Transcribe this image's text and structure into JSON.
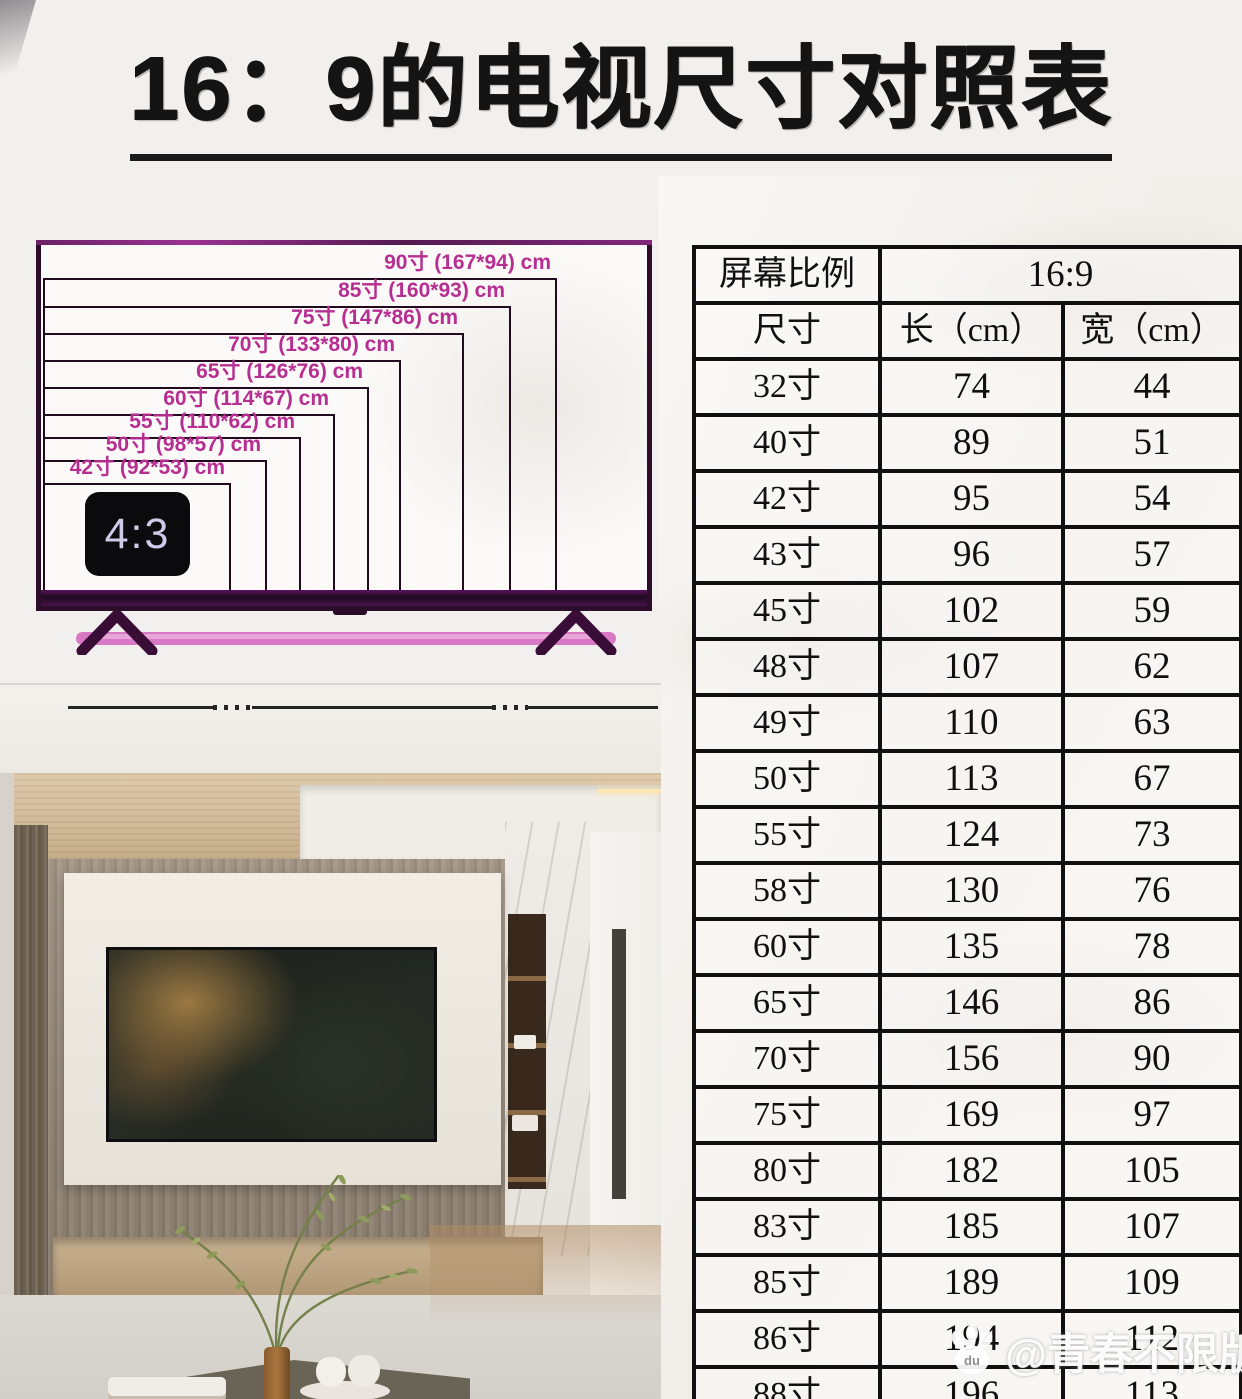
{
  "title": {
    "text": "16：9的电视尺寸对照表"
  },
  "diagram": {
    "aspect_badge": "4:3",
    "sizes": [
      {
        "label": "90寸 (167*94) cm",
        "size": "90寸",
        "length_cm": 167,
        "width_cm": 94
      },
      {
        "label": "85寸 (160*93) cm",
        "size": "85寸",
        "length_cm": 160,
        "width_cm": 93
      },
      {
        "label": "75寸 (147*86) cm",
        "size": "75寸",
        "length_cm": 147,
        "width_cm": 86
      },
      {
        "label": "70寸 (133*80) cm",
        "size": "70寸",
        "length_cm": 133,
        "width_cm": 80
      },
      {
        "label": "65寸 (126*76) cm",
        "size": "65寸",
        "length_cm": 126,
        "width_cm": 76
      },
      {
        "label": "60寸 (114*67) cm",
        "size": "60寸",
        "length_cm": 114,
        "width_cm": 67
      },
      {
        "label": "55寸 (110*62) cm",
        "size": "55寸",
        "length_cm": 110,
        "width_cm": 62
      },
      {
        "label": "50寸 (98*57) cm",
        "size": "50寸",
        "length_cm": 98,
        "width_cm": 57
      },
      {
        "label": "42寸 (92*53) cm",
        "size": "42寸",
        "length_cm": 92,
        "width_cm": 53
      }
    ]
  },
  "table": {
    "ratio_label": "屏幕比例",
    "ratio_value": "16:9",
    "columns": [
      "尺寸",
      "长（cm）",
      "宽（cm）"
    ],
    "rows": [
      [
        "32寸",
        "74",
        "44"
      ],
      [
        "40寸",
        "89",
        "51"
      ],
      [
        "42寸",
        "95",
        "54"
      ],
      [
        "43寸",
        "96",
        "57"
      ],
      [
        "45寸",
        "102",
        "59"
      ],
      [
        "48寸",
        "107",
        "62"
      ],
      [
        "49寸",
        "110",
        "63"
      ],
      [
        "50寸",
        "113",
        "67"
      ],
      [
        "55寸",
        "124",
        "73"
      ],
      [
        "58寸",
        "130",
        "76"
      ],
      [
        "60寸",
        "135",
        "78"
      ],
      [
        "65寸",
        "146",
        "86"
      ],
      [
        "70寸",
        "156",
        "90"
      ],
      [
        "75寸",
        "169",
        "97"
      ],
      [
        "80寸",
        "182",
        "105"
      ],
      [
        "83寸",
        "185",
        "107"
      ],
      [
        "85寸",
        "189",
        "109"
      ],
      [
        "86寸",
        "194",
        "112"
      ],
      [
        "88寸",
        "196",
        "113"
      ]
    ]
  },
  "watermark": {
    "text": "@青春不限版",
    "icon": "paw-icon",
    "icon_letters": "du"
  },
  "colors": {
    "accent_magenta": "#b72e92",
    "tv_frame_purple": "#2c0d2a",
    "stand_pink": "#d978c4",
    "table_border": "#101010",
    "title_black": "#141414"
  },
  "chart_data": {
    "type": "table",
    "title": "16：9的电视尺寸对照表",
    "screen_ratio": "16:9",
    "columns": [
      "尺寸",
      "长（cm）",
      "宽（cm）"
    ],
    "rows": [
      [
        "32寸",
        74,
        44
      ],
      [
        "40寸",
        89,
        51
      ],
      [
        "42寸",
        95,
        54
      ],
      [
        "43寸",
        96,
        57
      ],
      [
        "45寸",
        102,
        59
      ],
      [
        "48寸",
        107,
        62
      ],
      [
        "49寸",
        110,
        63
      ],
      [
        "50寸",
        113,
        67
      ],
      [
        "55寸",
        124,
        73
      ],
      [
        "58寸",
        130,
        76
      ],
      [
        "60寸",
        135,
        78
      ],
      [
        "65寸",
        146,
        86
      ],
      [
        "70寸",
        156,
        90
      ],
      [
        "75寸",
        169,
        97
      ],
      [
        "80寸",
        182,
        105
      ],
      [
        "83寸",
        185,
        107
      ],
      [
        "85寸",
        189,
        109
      ],
      [
        "86寸",
        194,
        112
      ],
      [
        "88寸",
        196,
        113
      ]
    ],
    "diagram_nested_sizes": [
      {
        "label": "90寸",
        "length_cm": 167,
        "width_cm": 94
      },
      {
        "label": "85寸",
        "length_cm": 160,
        "width_cm": 93
      },
      {
        "label": "75寸",
        "length_cm": 147,
        "width_cm": 86
      },
      {
        "label": "70寸",
        "length_cm": 133,
        "width_cm": 80
      },
      {
        "label": "65寸",
        "length_cm": 126,
        "width_cm": 76
      },
      {
        "label": "60寸",
        "length_cm": 114,
        "width_cm": 67
      },
      {
        "label": "55寸",
        "length_cm": 110,
        "width_cm": 62
      },
      {
        "label": "50寸",
        "length_cm": 98,
        "width_cm": 57
      },
      {
        "label": "42寸",
        "length_cm": 92,
        "width_cm": 53
      }
    ],
    "reference_aspect_badge": "4:3",
    "layout_hints": {
      "diagram_position": "top-left nested rectangles anchored bottom-left",
      "table_position": "right column, last row clipped",
      "grid": "on"
    }
  }
}
